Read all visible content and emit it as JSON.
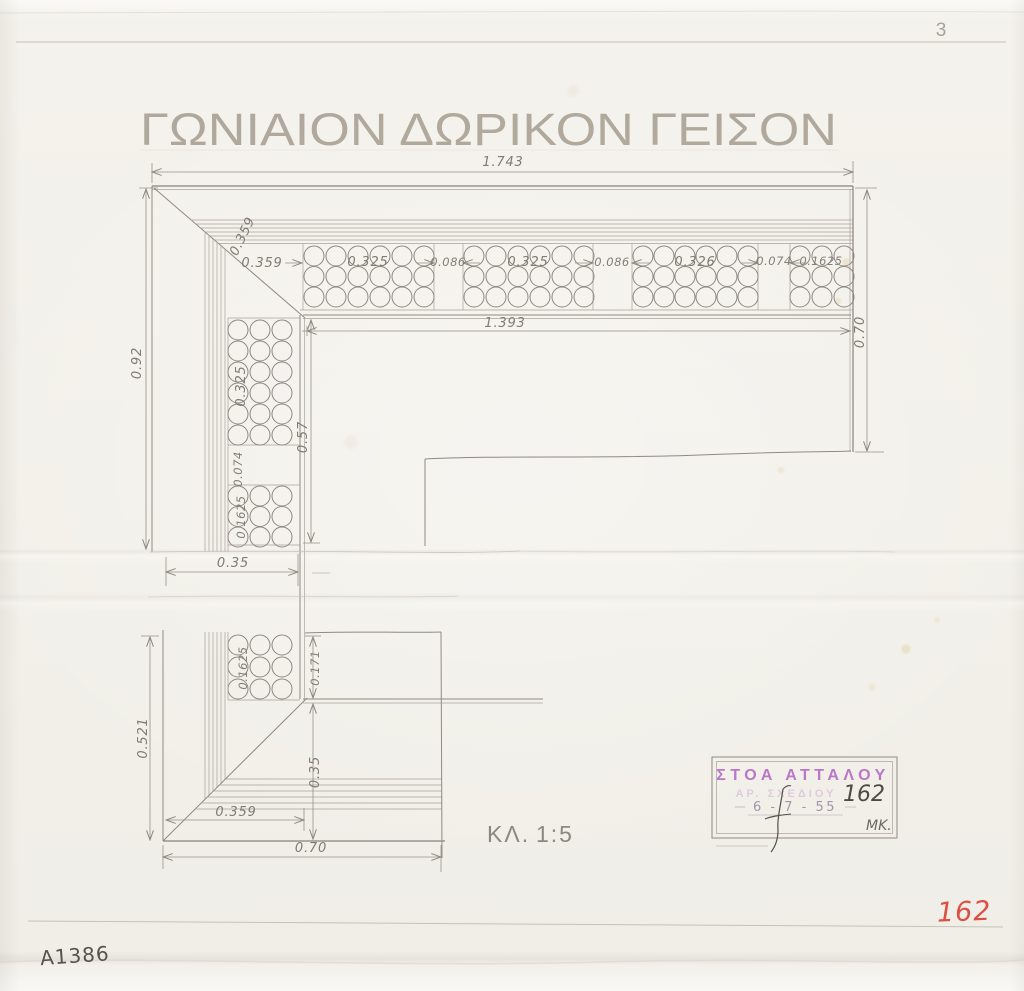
{
  "document": {
    "title": "ΓΩΝΙΑΙΟΝ ΔΩΡΙΚΟΝ ΓΕΙΣΟΝ",
    "sheet_number": "3",
    "catalog_number": "A1386",
    "inventory_number": "162",
    "scale_label": "ΚΛ.",
    "scale_value": "1:5"
  },
  "stamp": {
    "line1": "ΣΤΟΑ ΑΤΤΑΛΟΥ",
    "line2": "ΑΡ. ΣΧΕΔΙΟΥ",
    "number": "162",
    "date": "6 - 7 - 55",
    "initials": "MK."
  },
  "dims": {
    "top_total": "1.743",
    "soffit_length": "1.393",
    "corner_diagonal": "0.359",
    "corner_offset": "0.359",
    "mutule_1": "0.325",
    "via_1": "0.086",
    "mutule_2": "0.325",
    "via_2": "0.086",
    "mutule_3": "0.326",
    "via_3": "0.074",
    "mutule_4": "0.1625",
    "right_depth": "0.70",
    "left_height": "0.92",
    "left_mutule": "0.325",
    "left_via": "0.074",
    "left_mutule_2": "0.1625",
    "soffit_depth": "0.57",
    "left_width": "0.35",
    "lower_mutule": "0.1625",
    "lower_offset": "0.171",
    "lower_height": "0.521",
    "lower_inner": "0.35",
    "bottom_offset": "0.359",
    "bottom_total": "0.70"
  }
}
